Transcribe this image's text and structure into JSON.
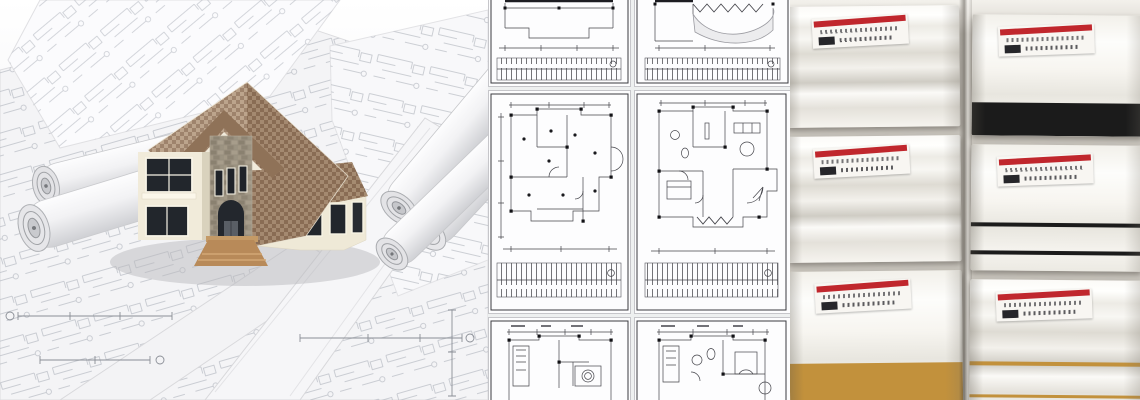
{
  "banner": {
    "kind": "photo-collage",
    "sections": [
      {
        "id": "house-render",
        "subject": "3d-house-model-on-rolled-blueprints"
      },
      {
        "id": "floorplan-grid",
        "subject": "architectural-floor-plan-sheets"
      },
      {
        "id": "moulding-samples",
        "subject": "white-pvc-moulding-profile-samples"
      }
    ]
  },
  "colors": {
    "photo_bg": "#cac6be",
    "label_red": "#c0272d",
    "band_black": "#1b1b1b",
    "band_gold": "#c2913c",
    "moulding_white": "#f6f4ef",
    "roof_shingle": "#a5886d",
    "wall_cream": "#f1ebda",
    "stone_facade": "#99907f",
    "steps_wood": "#b88a59",
    "blueprint_line": "#b6bac2",
    "plan_line": "#45454b"
  },
  "floorplan_grid": {
    "columns": 2,
    "rows": 3,
    "tiles": [
      {
        "id": "r1c1",
        "subject": "roof-plan-lower-half-with-dimension-strip"
      },
      {
        "id": "r1c2",
        "subject": "terrace-plan-with-wavy-edge-and-dimension-strip"
      },
      {
        "id": "r2c1",
        "subject": "ceiling-lighting-plan-with-dimension-strip"
      },
      {
        "id": "r2c2",
        "subject": "furnished-floor-plan-with-dimension-strip"
      },
      {
        "id": "r3c1",
        "subject": "floor-plan-upper-part-cropped"
      },
      {
        "id": "r3c2",
        "subject": "furnished-floor-plan-upper-part-cropped"
      }
    ]
  },
  "moulding_grid": {
    "columns": 2,
    "rows": 3,
    "label_style": "white-sticker-red-stripe-upside-down-illegible-text",
    "samples": [
      {
        "column": "left",
        "row": 1,
        "profile": "crown",
        "accents": []
      },
      {
        "column": "left",
        "row": 2,
        "profile": "crown",
        "accents": []
      },
      {
        "column": "left",
        "row": 3,
        "profile": "flat",
        "accents": [
          {
            "name": "wide-gold-band",
            "color": "band_gold",
            "height": 42,
            "bottom": 0
          }
        ]
      },
      {
        "column": "right",
        "row": 1,
        "profile": "flat",
        "accents": [
          {
            "name": "wide-black-band",
            "color": "band_black",
            "height": 33,
            "bottom": 0
          }
        ]
      },
      {
        "column": "right",
        "row": 2,
        "profile": "flat",
        "accents": [
          {
            "name": "black-pinstripe-upper",
            "color": "band_black",
            "height": 4,
            "bottom": 44
          },
          {
            "name": "black-pinstripe-lower",
            "color": "band_black",
            "height": 4,
            "bottom": 16
          }
        ]
      },
      {
        "column": "right",
        "row": 3,
        "profile": "crown",
        "accents": [
          {
            "name": "gold-pinstripe-upper",
            "color": "band_gold",
            "height": 4,
            "bottom": 48
          },
          {
            "name": "gold-pinstripe-lower",
            "color": "band_gold",
            "height": 3,
            "bottom": 16
          }
        ]
      }
    ]
  }
}
